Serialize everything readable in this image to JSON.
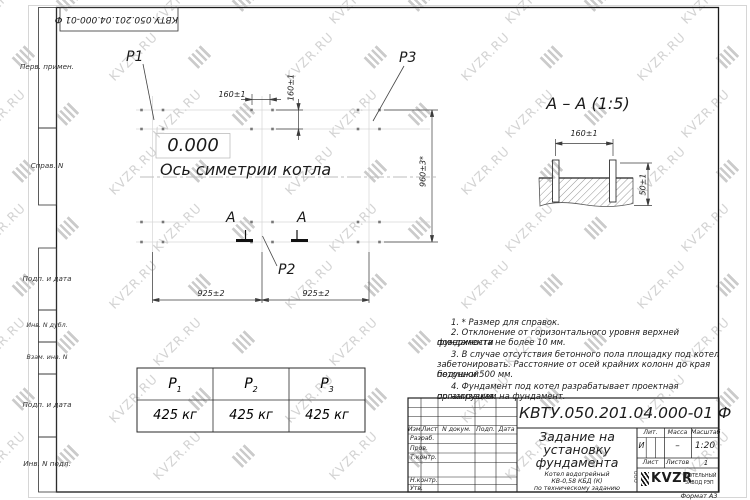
{
  "watermark": {
    "text": "KVZR.RU"
  },
  "corner_doc_number": "КВТУ.050.201.04.000-01 Ф",
  "stamp_column": {
    "items": [
      "Перв. примен.",
      "Справ. N",
      "Подп. и дата",
      "Инв. N дубл.",
      "Взам. инв. N",
      "Подп. и дата",
      "Инв. N подл."
    ]
  },
  "plan": {
    "labels": {
      "p1": "P1",
      "p2": "P2",
      "p3": "P3",
      "level": "0.000",
      "axis": "Ось симетрии котла",
      "section_letter_left": "A",
      "section_letter_right": "A"
    },
    "dims": {
      "top_h": "160±1",
      "top_v": "160±1",
      "right": "960±3*",
      "bottom_left": "925±2",
      "bottom_right": "925±2"
    }
  },
  "section_view": {
    "title": "A – A (1:5)",
    "dim_width": "160±1",
    "dim_height": "50±1"
  },
  "notes": {
    "lines": [
      "1. * Размер для справок.",
      "2. Отклонение от горизонтального уровня верхней поверхности",
      "фундамента не более 10 мм.",
      "3. В случае отсутствия бетонного пола площадку под котел",
      "забетонировать. Расстояние от осей крайних колонн до края бетонной",
      "подушки 500 мм.",
      "4. Фундамент под котел разрабатывает проектная организация",
      "по нагрузкам на фундамент."
    ]
  },
  "load_table": {
    "headers": [
      {
        "base": "P",
        "sub": "1"
      },
      {
        "base": "P",
        "sub": "2"
      },
      {
        "base": "P",
        "sub": "3"
      }
    ],
    "values": [
      "425 кг",
      "425 кг",
      "425 кг"
    ]
  },
  "title_block": {
    "doc_number": "КВТУ.050.201.04.000-01 Ф",
    "title_lines": [
      "Задание на",
      "установку",
      "фундамента"
    ],
    "subtitle_lines": [
      "Котел водогрейный",
      "КВ-0,58 КБД (К)",
      "по техническому заданию"
    ],
    "header_cells": [
      "Изм.",
      "Лист",
      "N докум.",
      "Подп.",
      "Дата"
    ],
    "row_labels": [
      "Разраб.",
      "Пров.",
      "Т.контр.",
      "Н.контр.",
      "Утв."
    ],
    "lit_header": "Лит.",
    "mass_header": "Масса",
    "scale_header": "Масштаб",
    "lit_value": "И",
    "mass_value": "–",
    "scale_value": "1:20",
    "sheet_label": "Лист",
    "sheets_label": "Листов",
    "sheets_value": "1",
    "logo": {
      "ooo": "ООО",
      "name": "KVZR",
      "caption_lines": [
        "КОТЕЛЬНЫЙ",
        "ЗАВОД РЭП"
      ]
    },
    "format_label": "Формат А3"
  }
}
